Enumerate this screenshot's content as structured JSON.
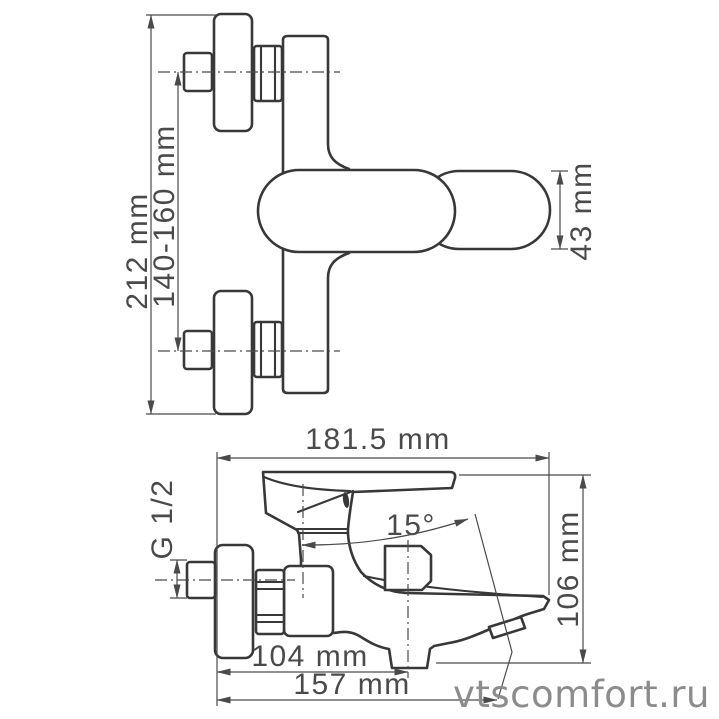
{
  "watermark": "vtscomfort.ru",
  "front_view": {
    "dim_height": "212 mm",
    "dim_mounting": "140-160 mm",
    "dim_body": "43 mm"
  },
  "side_view": {
    "dim_depth": "181.5 mm",
    "dim_thread": "G 1/2",
    "dim_angle": "15°",
    "dim_height": "106 mm",
    "dim_spout": "104 mm",
    "dim_total": "157 mm"
  },
  "colors": {
    "outline": "#38383a",
    "dimension": "#4a4a4c",
    "watermark": "#8c8c8c",
    "background": "#ffffff"
  }
}
